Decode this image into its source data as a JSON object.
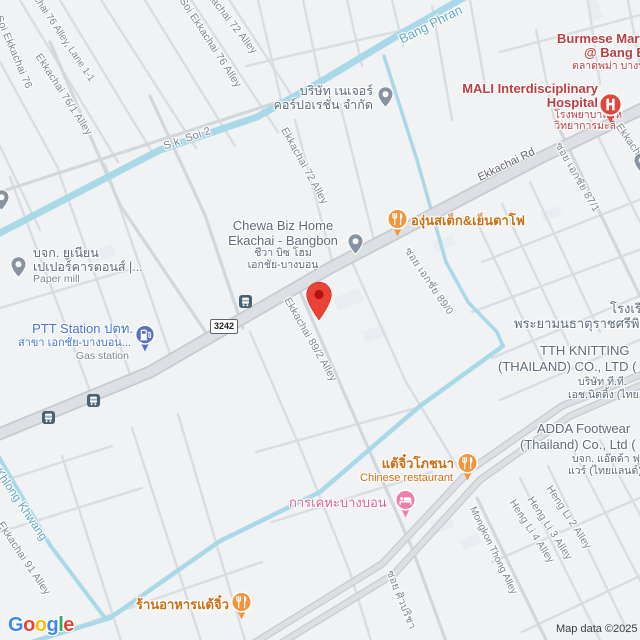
{
  "map": {
    "attribution": "Map data ©2025",
    "route_shield": "3242",
    "logo_letters": [
      "G",
      "o",
      "o",
      "g",
      "l",
      "e"
    ]
  },
  "colors": {
    "background": "#f0f2f4",
    "road_fill": "#dce0e4",
    "road_casing": "#c6cbd1",
    "minor_street": "#d9dde2",
    "water": "#a9d9e8",
    "water_label": "#62a7bd",
    "street_label": "#7e868d",
    "poi_grey": "#5d6b7a",
    "poi_red": "#bc3d41",
    "poi_orange": "#c96e12",
    "poi_blue": "#4372d8",
    "poi_pink": "#dd6192",
    "marker_red": "#EA4335"
  },
  "streets": [
    {
      "text": "Soi Ekkachai 76"
    },
    {
      "text": "Ekkachai 76 Alley, Lane 1-1"
    },
    {
      "text": "Ekkachai 76/1 Alley"
    },
    {
      "text": "Ekkachai 72 Alley"
    },
    {
      "text": "Soi Ekkachai 76 Alley"
    },
    {
      "text": "S.k. Soi 2"
    },
    {
      "text": "Ekkachai 72 Alley"
    },
    {
      "text": "Ekkachai Rd"
    },
    {
      "text": "ซอย เอกชัย 89/0"
    },
    {
      "text": "ซอย เอกชัย 87/1"
    },
    {
      "text": "Ekkachai"
    },
    {
      "text": "Ekkachai 89/2 Alley"
    },
    {
      "text": "Ekkachai 91 Alley"
    },
    {
      "text": "Heng Li 2 Alley"
    },
    {
      "text": "Heng Li 3 Alley"
    },
    {
      "text": "Heng Li 4 Alley"
    },
    {
      "text": "Mongkon Thong Alley"
    },
    {
      "text": "ซอย ศิวปริชา"
    },
    {
      "text": "Alley"
    }
  ],
  "waterways": [
    {
      "text": "Bang Phran"
    },
    {
      "text": "Khlong Khwang"
    }
  ],
  "pois": {
    "nature_corp": {
      "line1": "บริษัท เนเจอร์",
      "line2": "คอร์ปอเรชั่น จำกัด"
    },
    "burmese_mart": {
      "line1": "Burmese Mart",
      "line2": "@ Bang Bo",
      "line3": "ตลาดพม่า บางบ"
    },
    "mali_hospital": {
      "line1": "MALI Interdisciplinary",
      "line2": "Hospital",
      "line3": "โรงพยาบาลสห",
      "line4": "วิทยาการมะลิ"
    },
    "chewa": {
      "line1": "Chewa Biz Home",
      "line2": "Ekachai - Bangbon",
      "line3": "ชีวา บิซ โฮม",
      "line4": "เอกชัย-บางบอน"
    },
    "grape_restaurant": {
      "line1": "องุ่นสเต็ก&เย็นตาโฟ"
    },
    "ptt": {
      "line1": "PTT Station ปตท.",
      "line2": "สาขา เอกชัย-บางบอน...",
      "line3": "Gas station"
    },
    "paper_mill": {
      "line1": "บจก. ยูเนียน",
      "line2": "เปเปอร์คารตอนส์ |...",
      "line3": "Paper mill"
    },
    "tth_knitting": {
      "line1": "TTH KNITTING",
      "line2": "(THAILAND) CO., LTD (",
      "line3": "บริษัท ที.ที.",
      "line4": "เอช.นิตติ้ง (ไทย..."
    },
    "school": {
      "line1": "โรงเรี",
      "line2": "พระยามนธาตุราชศรีพิจิ"
    },
    "adda": {
      "line1": "ADDA Footwear",
      "line2": "(Thailand) Co., Ltd (",
      "line3": "บจก. แอ๊ดด้า ฟุต",
      "line4": "แวร์ (ไทยแลนด์)"
    },
    "kankeha": {
      "line1": "การเคหะบางบอน"
    },
    "chinese_restaurant": {
      "line1": "แต้จิ๋วโภชนา",
      "line2": "Chinese restaurant"
    },
    "taejiew_restaurant": {
      "line1": "ร้านอาหารแต้จิ๋ว"
    }
  }
}
